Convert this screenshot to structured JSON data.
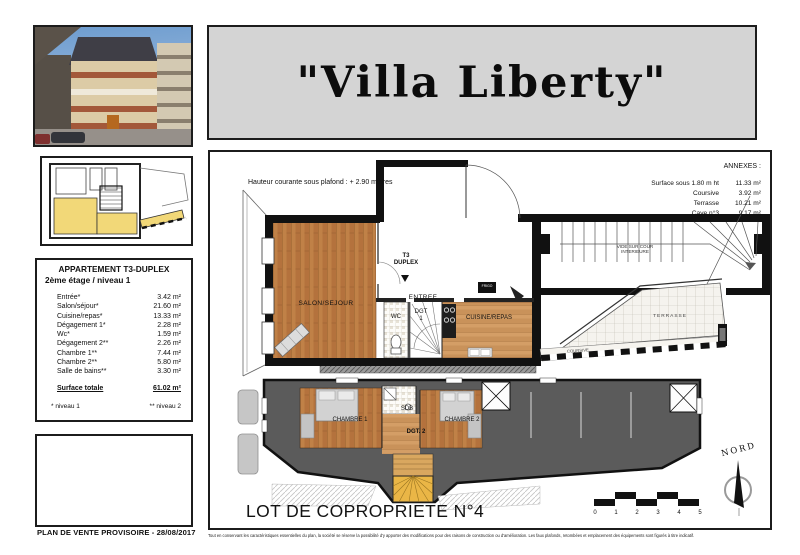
{
  "page": {
    "title": "\"Villa Liberty\"",
    "plan_caption": "PLAN DE VENTE PROVISOIRE - 28/08/2017",
    "disclaimer": "Tout en conservant les caractéristiques essentielles du plan, la société se réserve la possibilité d'y apporter des modifications pour des raisons de construction ou d'amélioration. Les faux plafonds, retombées et emplacement des équipements sont figurés à titre indicatif."
  },
  "apartment": {
    "title": "APPARTEMENT T3-DUPLEX",
    "subtitle": "2ème étage / niveau 1",
    "rooms": [
      {
        "label": "Entrée*",
        "value": "3.42 m²"
      },
      {
        "label": "Salon/séjour*",
        "value": "21.60 m²"
      },
      {
        "label": "Cuisine/repas*",
        "value": "13.33 m²"
      },
      {
        "label": "Dégagement 1*",
        "value": "2.28 m²"
      },
      {
        "label": "Wc*",
        "value": "1.59 m²"
      },
      {
        "label": "Dégagement 2**",
        "value": "2.26 m²"
      },
      {
        "label": "Chambre 1**",
        "value": "7.44 m²"
      },
      {
        "label": "Chambre 2**",
        "value": "5.80 m²"
      },
      {
        "label": "Salle de bains**",
        "value": "3.30 m²"
      }
    ],
    "total_label": "Surface totale",
    "total_value": "61.02 m²",
    "footnote_left": "* niveau 1",
    "footnote_right": "** niveau 2"
  },
  "annexes": {
    "title": "ANNEXES :",
    "rows": [
      {
        "label": "Surface sous 1.80 m ht",
        "value": "11.33 m²"
      },
      {
        "label": "Coursive",
        "value": "3.92 m²"
      },
      {
        "label": "Terrasse",
        "value": "10.21 m²"
      },
      {
        "label": "Cave n°3",
        "value": "9.17 m²"
      }
    ]
  },
  "plan": {
    "ceiling_note": "Hauteur courante sous plafond : + 2.90 mètres",
    "duplex_label_line1": "T3",
    "duplex_label_line2": "DUPLEX",
    "duplex_arrow": "▼",
    "lot_label": "LOT DE COPROPRIETE N°4",
    "north_label": "NORD",
    "scale_ticks": [
      "0",
      "1",
      "2",
      "3",
      "4",
      "5"
    ],
    "level1_rooms": {
      "salon": "SALON/SEJOUR",
      "entree": "ENTREE",
      "wc": "WC",
      "dgt": "DGT",
      "dgt_num": "1",
      "cuisine": "CUISINE/REPAS",
      "frigo": "FRIGO"
    },
    "level2_rooms": {
      "chambre1": "CHAMBRE 1",
      "sdb": "SDB",
      "chambre2": "CHAMBRE 2",
      "dgt2": "DGT. 2"
    },
    "exterior": {
      "vide_line1": "VIDE SUR COUR",
      "vide_line2": "INTERIEURE",
      "terrasse": "TERRASSE",
      "coursive": "COURSIVE"
    }
  },
  "colors": {
    "wood": "#b4723d",
    "wood_light": "#c9925a",
    "attic_gray": "#5b5b5b",
    "stair_yellow": "#eab646",
    "banner_gray": "#d4d4d4",
    "sketch_yellow": "#f2d878"
  }
}
